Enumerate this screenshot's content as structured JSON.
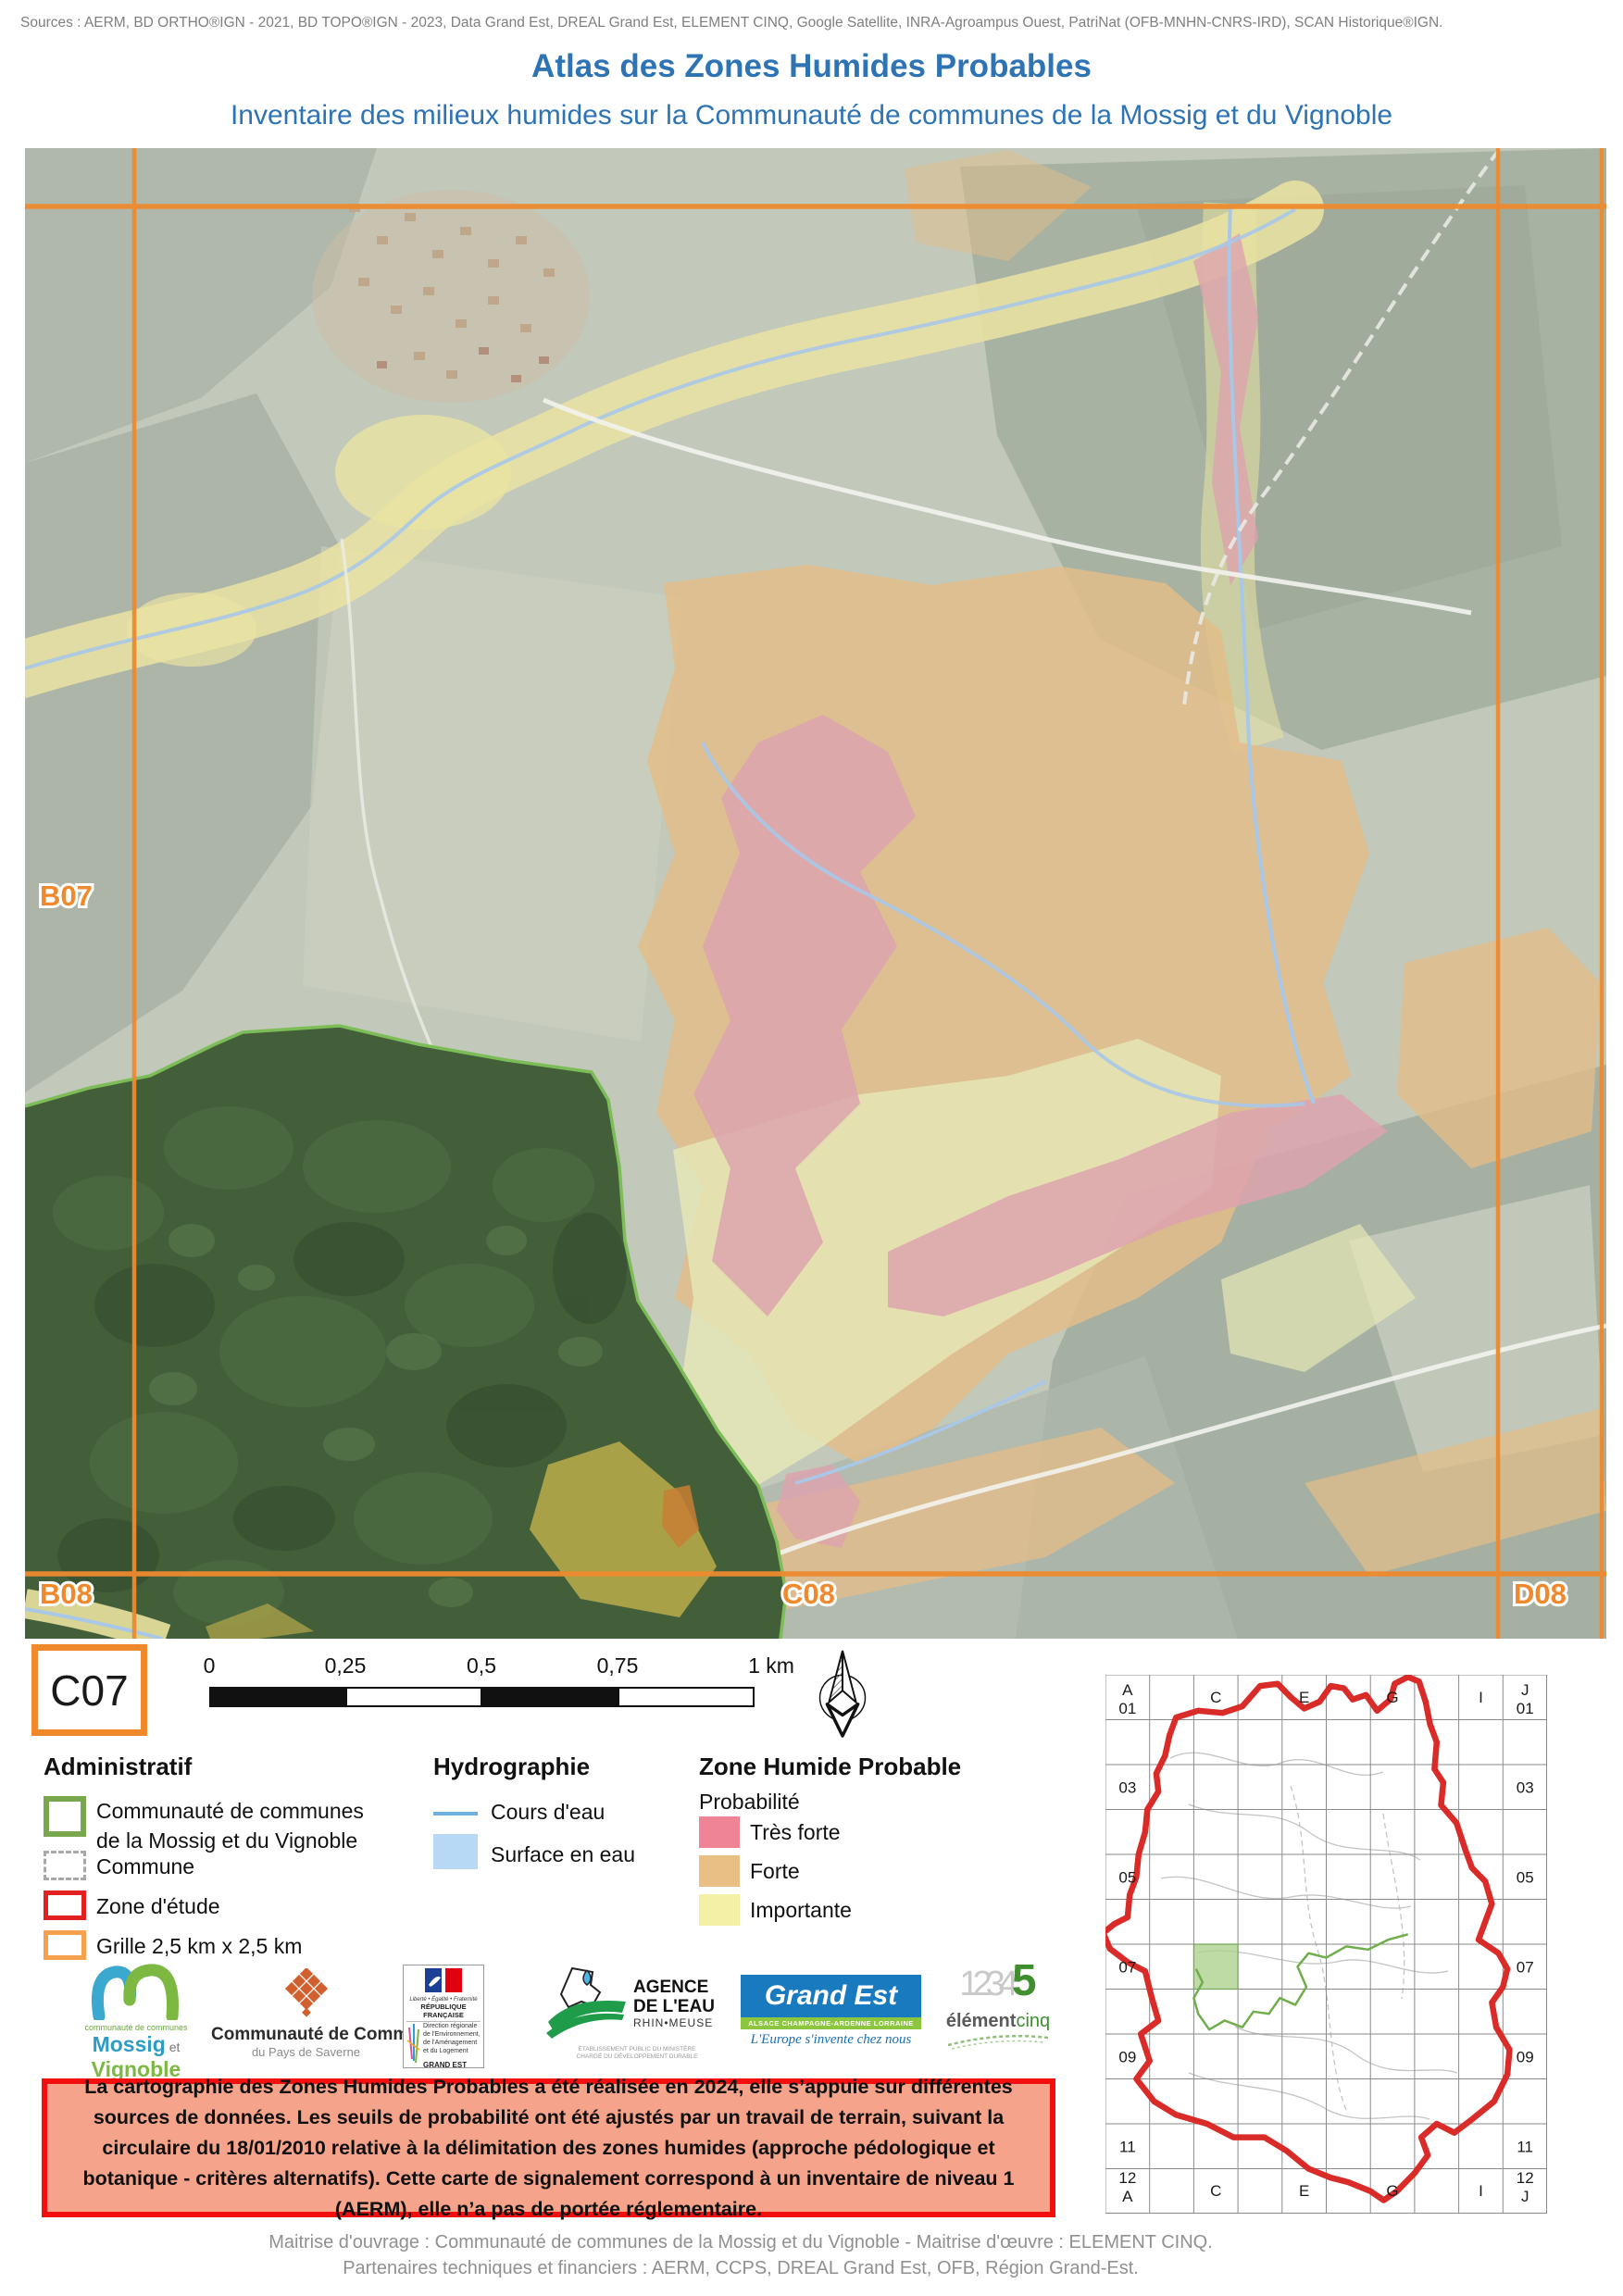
{
  "page": {
    "sources": "Sources : AERM, BD ORTHO®IGN - 2021, BD TOPO®IGN - 2023, Data Grand Est, DREAL Grand Est, ELEMENT CINQ, Google Satellite, INRA-Agroampus Ouest, PatriNat (OFB-MNHN-CNRS-IRD), SCAN Historique®IGN.",
    "title": "Atlas des Zones Humides Probables",
    "subtitle": "Inventaire des milieux humides sur la Communauté de communes de la Mossig et du Vignoble",
    "footer_line1": "Maitrise d'ouvrage : Communauté de communes de la Mossig et du Vignoble - Maitrise d'œuvre : ELEMENT CINQ.",
    "footer_line2": "Partenaires techniques et financiers : AERM, CCPS, DREAL Grand Est, OFB, Région Grand-Est."
  },
  "map": {
    "current_cell": "C07",
    "labels": {
      "b07": "B07",
      "b08": "B08",
      "c08": "C08",
      "d08": "D08"
    }
  },
  "scalebar": {
    "labels": [
      "0",
      "0,25",
      "0,5",
      "0,75",
      "1 km"
    ]
  },
  "legend": {
    "administratif": {
      "title": "Administratif",
      "cc_line1": "Communauté de communes",
      "cc_line2": "de la Mossig et du Vignoble",
      "commune": "Commune",
      "zone_etude": "Zone d'étude",
      "grille": "Grille 2,5 km x 2,5 km"
    },
    "hydrographie": {
      "title": "Hydrographie",
      "cours": "Cours d'eau",
      "surface": "Surface en eau"
    },
    "zhp": {
      "title": "Zone Humide Probable",
      "subtitle": "Probabilité",
      "items": [
        {
          "label": "Très forte",
          "color": "#ee8495"
        },
        {
          "label": "Forte",
          "color": "#eabf85"
        },
        {
          "label": "Importante",
          "color": "#f4f0a6"
        }
      ]
    }
  },
  "notice": {
    "text": "La cartographie des Zones Humides Probables a été réalisée en 2024, elle s’appuie sur différentes sources de données. Les seuils de probabilité ont été ajustés par un travail de terrain, suivant la circulaire du 18/01/2010 relative à la délimitation des zones humides (approche pédologique et botanique - critères alternatifs). Cette carte de signalement correspond à un inventaire de niveau 1 (AERM), elle n’a pas de portée réglementaire."
  },
  "logos": {
    "mossig": {
      "small": "communauté de communes",
      "name1": "Mossig",
      "et": " et ",
      "name2": "Vignoble",
      "region": "Alsace"
    },
    "saverne": {
      "line1": "Communauté de Communes",
      "line2": "du Pays de Saverne"
    },
    "dreal": {
      "motto": "Liberté • Égalité • Fraternité",
      "republique": "RÉPUBLIQUE FRANÇAISE",
      "dir1": "Direction régionale",
      "dir2": "de l'Environnement,",
      "dir3": "de l'Aménagement",
      "dir4": "et du Logement",
      "region": "GRAND EST"
    },
    "agence": {
      "l1": "AGENCE",
      "l2": "DE L'EAU",
      "l3": "RHIN•MEUSE",
      "sub1": "ÉTABLISSEMENT PUBLIC DU MINISTÈRE",
      "sub2": "CHARGÉ DU DÉVELOPPEMENT DURABLE"
    },
    "grandest": {
      "name": "Grand Est",
      "strip": "ALSACE CHAMPAGNE-ARDENNE LORRAINE",
      "tagline": "L'Europe s'invente chez nous"
    },
    "element5": {
      "digits": "1234",
      "five": "5",
      "name1": "élément",
      "name2": "cinq"
    }
  },
  "overview": {
    "corners": {
      "tl1": "A",
      "tl2": "01",
      "tr1": "J",
      "tr2": "01",
      "bl1": "12",
      "bl2": "A",
      "br1": "12",
      "br2": "J"
    },
    "cols": [
      "C",
      "E",
      "G",
      "I"
    ],
    "rows": [
      "03",
      "05",
      "07",
      "09",
      "11"
    ]
  },
  "colors": {
    "title_blue": "#2e74b5",
    "grid_orange": "#ee8a2e",
    "tres_forte": "#ee8495",
    "forte": "#eabf85",
    "importante": "#f4f0a6",
    "zone_etude_red": "#e02020",
    "cc_green": "#78a74e",
    "notice_bg": "#f5a38a",
    "notice_border": "#f40f0f"
  }
}
